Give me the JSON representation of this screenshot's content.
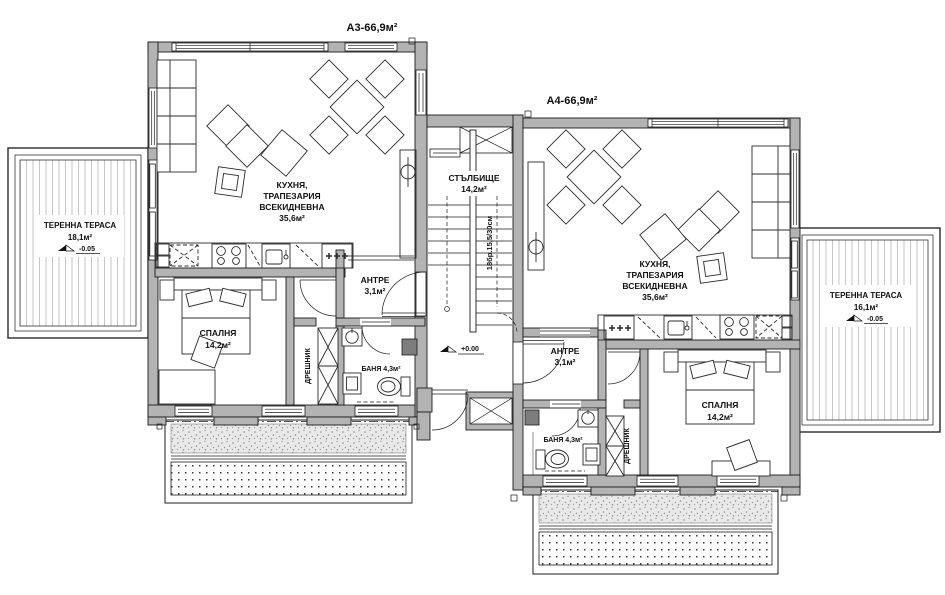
{
  "colors": {
    "wall": "#b3b3b3",
    "line": "#1b1b1b",
    "hatch": "#c6c6c6",
    "paper": "#ffffff"
  },
  "apartments": {
    "a3": {
      "title": "А3-66,9м²",
      "living": {
        "line1": "КУХНЯ,",
        "line2": "ТРАПЕЗАРИЯ",
        "line3": "ВСЕКИДНЕВНА",
        "area": "35,6м²"
      },
      "bedroom": {
        "name": "СПАЛНЯ",
        "area": "14,2м²"
      },
      "bath": {
        "name": "БАНЯ 4,3м²"
      },
      "antre": {
        "name": "АНТРЕ",
        "area": "3,1м²"
      },
      "closet": {
        "name": "ДРЕШНИК"
      },
      "terrace": {
        "name": "ТЕРЕННА ТЕРАСА",
        "area": "18,1м²",
        "level": "-0.05"
      }
    },
    "a4": {
      "title": "А4-66,9м²",
      "living": {
        "line1": "КУХНЯ,",
        "line2": "ТРАПЕЗАРИЯ",
        "line3": "ВСЕКИДНЕВНА",
        "area": "35,6м²"
      },
      "bedroom": {
        "name": "СПАЛНЯ",
        "area": "14,2м²"
      },
      "bath": {
        "name": "БАНЯ 4,3м²"
      },
      "antre": {
        "name": "АНТРЕ",
        "area": "3,1м²"
      },
      "closet": {
        "name": "ДРЕШНИК"
      },
      "terrace": {
        "name": "ТЕРЕННА ТЕРАСА",
        "area": "16,1м²",
        "level": "-0.05"
      }
    }
  },
  "stairwell": {
    "name": "СТЪЛБИЩЕ",
    "area": "14,2м²",
    "steps_note": "18бр.15,5/30см",
    "level": "+0.00"
  }
}
